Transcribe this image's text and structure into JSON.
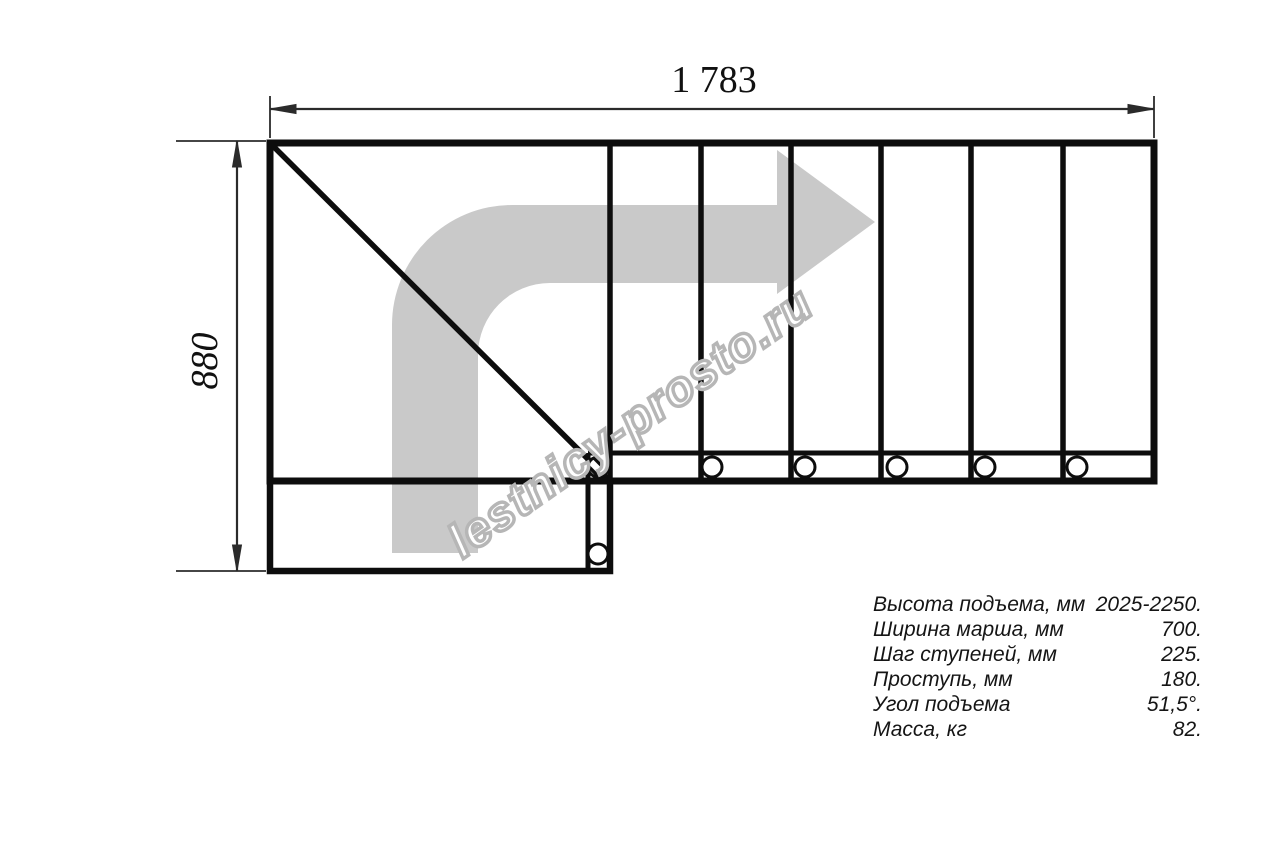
{
  "page": {
    "background": "#ffffff"
  },
  "drawing": {
    "dim_width_label": "1 783",
    "dim_height_label": "880",
    "line_color": "#0d0d0d",
    "dim_color": "#2b2b2b",
    "arrow_color": "#c9c9c9",
    "watermark_text": "lestnicy-prosto.ru",
    "watermark_color": "#b6b6b6"
  },
  "specs": {
    "rows": [
      {
        "label": "Высота подъема, мм",
        "value": "2025-2250."
      },
      {
        "label": "Ширина марша, мм",
        "value": "700."
      },
      {
        "label": "Шаг ступеней, мм",
        "value": "225."
      },
      {
        "label": "Проступь, мм",
        "value": "180."
      },
      {
        "label": "Угол подъема",
        "value": "51,5°."
      },
      {
        "label": "Масса, кг",
        "value": "82."
      }
    ]
  }
}
